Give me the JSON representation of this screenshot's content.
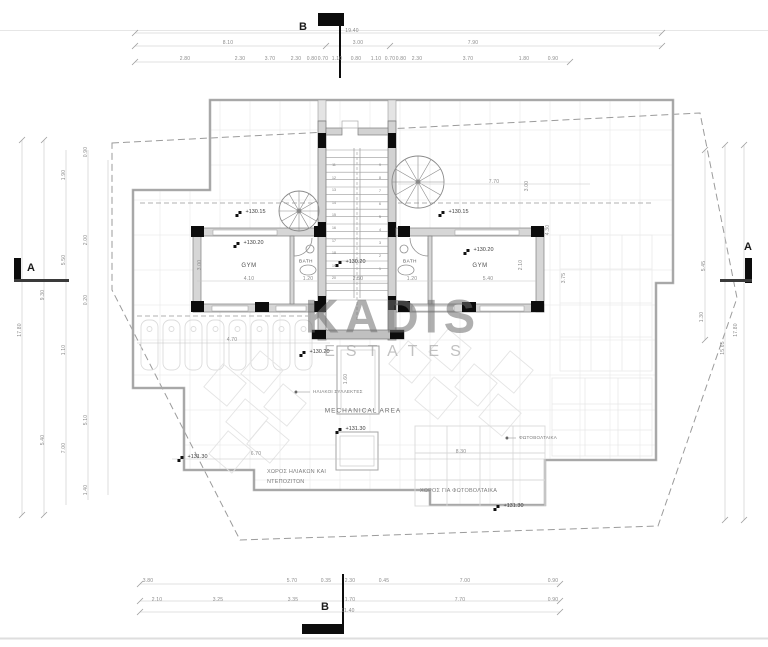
{
  "drawing": {
    "watermark": {
      "line1": "KADIS",
      "line2": "ESTATES"
    },
    "section_markers": {
      "top": "B",
      "bottom": "B",
      "left": "A",
      "right": "A"
    },
    "rooms": {
      "gym_left": "GYM",
      "bath_left": "BATH",
      "bath_right": "BATH",
      "gym_right": "GYM",
      "mechanical": "MECHANICAL AREA"
    },
    "area_labels": {
      "solar_collectors": "ΗΛΙΑΚΟΙ ΣΥΛΛΕΚΤΕΣ",
      "photovoltaics": "ΦΩΤΟΒΟΛΤΑΙΚΑ",
      "solar_area_line1": "ΧΩΡΟΣ ΗΛΙΑΚΩΝ ΚΑΙ",
      "solar_area_line2": "ΝΤΕΠΟΖΙΤΩΝ",
      "pv_area": "ΧΩΡΟΣ ΓΙΑ ΦΩΤΟΒΟΛΤΑΙΚΑ"
    },
    "elevations": [
      {
        "t": "+130.15",
        "x": 252,
        "y": 212
      },
      {
        "t": "+130.15",
        "x": 455,
        "y": 212
      },
      {
        "t": "+130.20",
        "x": 250,
        "y": 243
      },
      {
        "t": "+130.20",
        "x": 480,
        "y": 250
      },
      {
        "t": "+130.20",
        "x": 352,
        "y": 262
      },
      {
        "t": "+130.20",
        "x": 316,
        "y": 352
      },
      {
        "t": "+131.30",
        "x": 352,
        "y": 429
      },
      {
        "t": "+131.30",
        "x": 194,
        "y": 457
      },
      {
        "t": "+131.30",
        "x": 510,
        "y": 506
      }
    ],
    "dimensions": {
      "horizontal": [
        {
          "t": "19.40",
          "x": 352,
          "y": 31
        },
        {
          "t": "8.10",
          "x": 228,
          "y": 43
        },
        {
          "t": "3.00",
          "x": 358,
          "y": 43
        },
        {
          "t": "7.90",
          "x": 473,
          "y": 43
        },
        {
          "t": "2.80",
          "x": 185,
          "y": 59
        },
        {
          "t": "2.30",
          "x": 240,
          "y": 59
        },
        {
          "t": "3.70",
          "x": 270,
          "y": 59
        },
        {
          "t": "2.30",
          "x": 296,
          "y": 59
        },
        {
          "t": "0.80",
          "x": 312,
          "y": 59
        },
        {
          "t": "0.70",
          "x": 323,
          "y": 59
        },
        {
          "t": "1.10",
          "x": 337,
          "y": 59
        },
        {
          "t": "0.80",
          "x": 356,
          "y": 59
        },
        {
          "t": "1.10",
          "x": 376,
          "y": 59
        },
        {
          "t": "0.70",
          "x": 390,
          "y": 59
        },
        {
          "t": "0.80",
          "x": 401,
          "y": 59
        },
        {
          "t": "2.30",
          "x": 417,
          "y": 59
        },
        {
          "t": "3.70",
          "x": 468,
          "y": 59
        },
        {
          "t": "1.80",
          "x": 524,
          "y": 59
        },
        {
          "t": "0.90",
          "x": 553,
          "y": 59
        },
        {
          "t": "7.70",
          "x": 494,
          "y": 182
        },
        {
          "t": "4.10",
          "x": 249,
          "y": 279
        },
        {
          "t": "1.20",
          "x": 308,
          "y": 279
        },
        {
          "t": "2.50",
          "x": 358,
          "y": 279
        },
        {
          "t": "1.20",
          "x": 412,
          "y": 279
        },
        {
          "t": "5.40",
          "x": 488,
          "y": 279
        },
        {
          "t": "4.70",
          "x": 232,
          "y": 340
        },
        {
          "t": "6.70",
          "x": 256,
          "y": 454
        },
        {
          "t": "8.30",
          "x": 461,
          "y": 452
        },
        {
          "t": "3.80",
          "x": 148,
          "y": 581
        },
        {
          "t": "5.70",
          "x": 292,
          "y": 581
        },
        {
          "t": "0.35",
          "x": 326,
          "y": 581
        },
        {
          "t": "2.30",
          "x": 350,
          "y": 581
        },
        {
          "t": "0.45",
          "x": 384,
          "y": 581
        },
        {
          "t": "7.00",
          "x": 465,
          "y": 581
        },
        {
          "t": "0.90",
          "x": 553,
          "y": 581
        },
        {
          "t": "2.10",
          "x": 157,
          "y": 600
        },
        {
          "t": "3.25",
          "x": 218,
          "y": 600
        },
        {
          "t": "3.35",
          "x": 293,
          "y": 600
        },
        {
          "t": "1.70",
          "x": 350,
          "y": 600
        },
        {
          "t": "7.70",
          "x": 460,
          "y": 600
        },
        {
          "t": "0.90",
          "x": 553,
          "y": 600
        },
        {
          "t": "11.40",
          "x": 348,
          "y": 611
        }
      ],
      "vertical": [
        {
          "t": "17.80",
          "x": 20,
          "y": 330
        },
        {
          "t": "9.30",
          "x": 43,
          "y": 295
        },
        {
          "t": "5.40",
          "x": 43,
          "y": 440
        },
        {
          "t": "1.90",
          "x": 64,
          "y": 175
        },
        {
          "t": "5.50",
          "x": 64,
          "y": 260
        },
        {
          "t": "1.10",
          "x": 64,
          "y": 350
        },
        {
          "t": "7.00",
          "x": 64,
          "y": 448
        },
        {
          "t": "0.90",
          "x": 86,
          "y": 152
        },
        {
          "t": "2.00",
          "x": 86,
          "y": 240
        },
        {
          "t": "0.20",
          "x": 86,
          "y": 300
        },
        {
          "t": "5.10",
          "x": 86,
          "y": 420
        },
        {
          "t": "1.40",
          "x": 86,
          "y": 490
        },
        {
          "t": "3.00",
          "x": 200,
          "y": 265
        },
        {
          "t": "1.60",
          "x": 346,
          "y": 379
        },
        {
          "t": "2.10",
          "x": 521,
          "y": 265
        },
        {
          "t": "4.30",
          "x": 548,
          "y": 230
        },
        {
          "t": "3.75",
          "x": 564,
          "y": 278
        },
        {
          "t": "3.00",
          "x": 527,
          "y": 186
        },
        {
          "t": "5.45",
          "x": 704,
          "y": 266
        },
        {
          "t": "1.30",
          "x": 702,
          "y": 317
        },
        {
          "t": "17.80",
          "x": 736,
          "y": 330
        },
        {
          "t": "15.65",
          "x": 723,
          "y": 348
        }
      ]
    },
    "stair_numbers": {
      "left": [
        "11",
        "12",
        "13",
        "14",
        "15",
        "16",
        "17",
        "18",
        "19",
        "20"
      ],
      "right": [
        "9",
        "8",
        "7",
        "6",
        "5",
        "4",
        "3",
        "2",
        "1"
      ]
    }
  }
}
